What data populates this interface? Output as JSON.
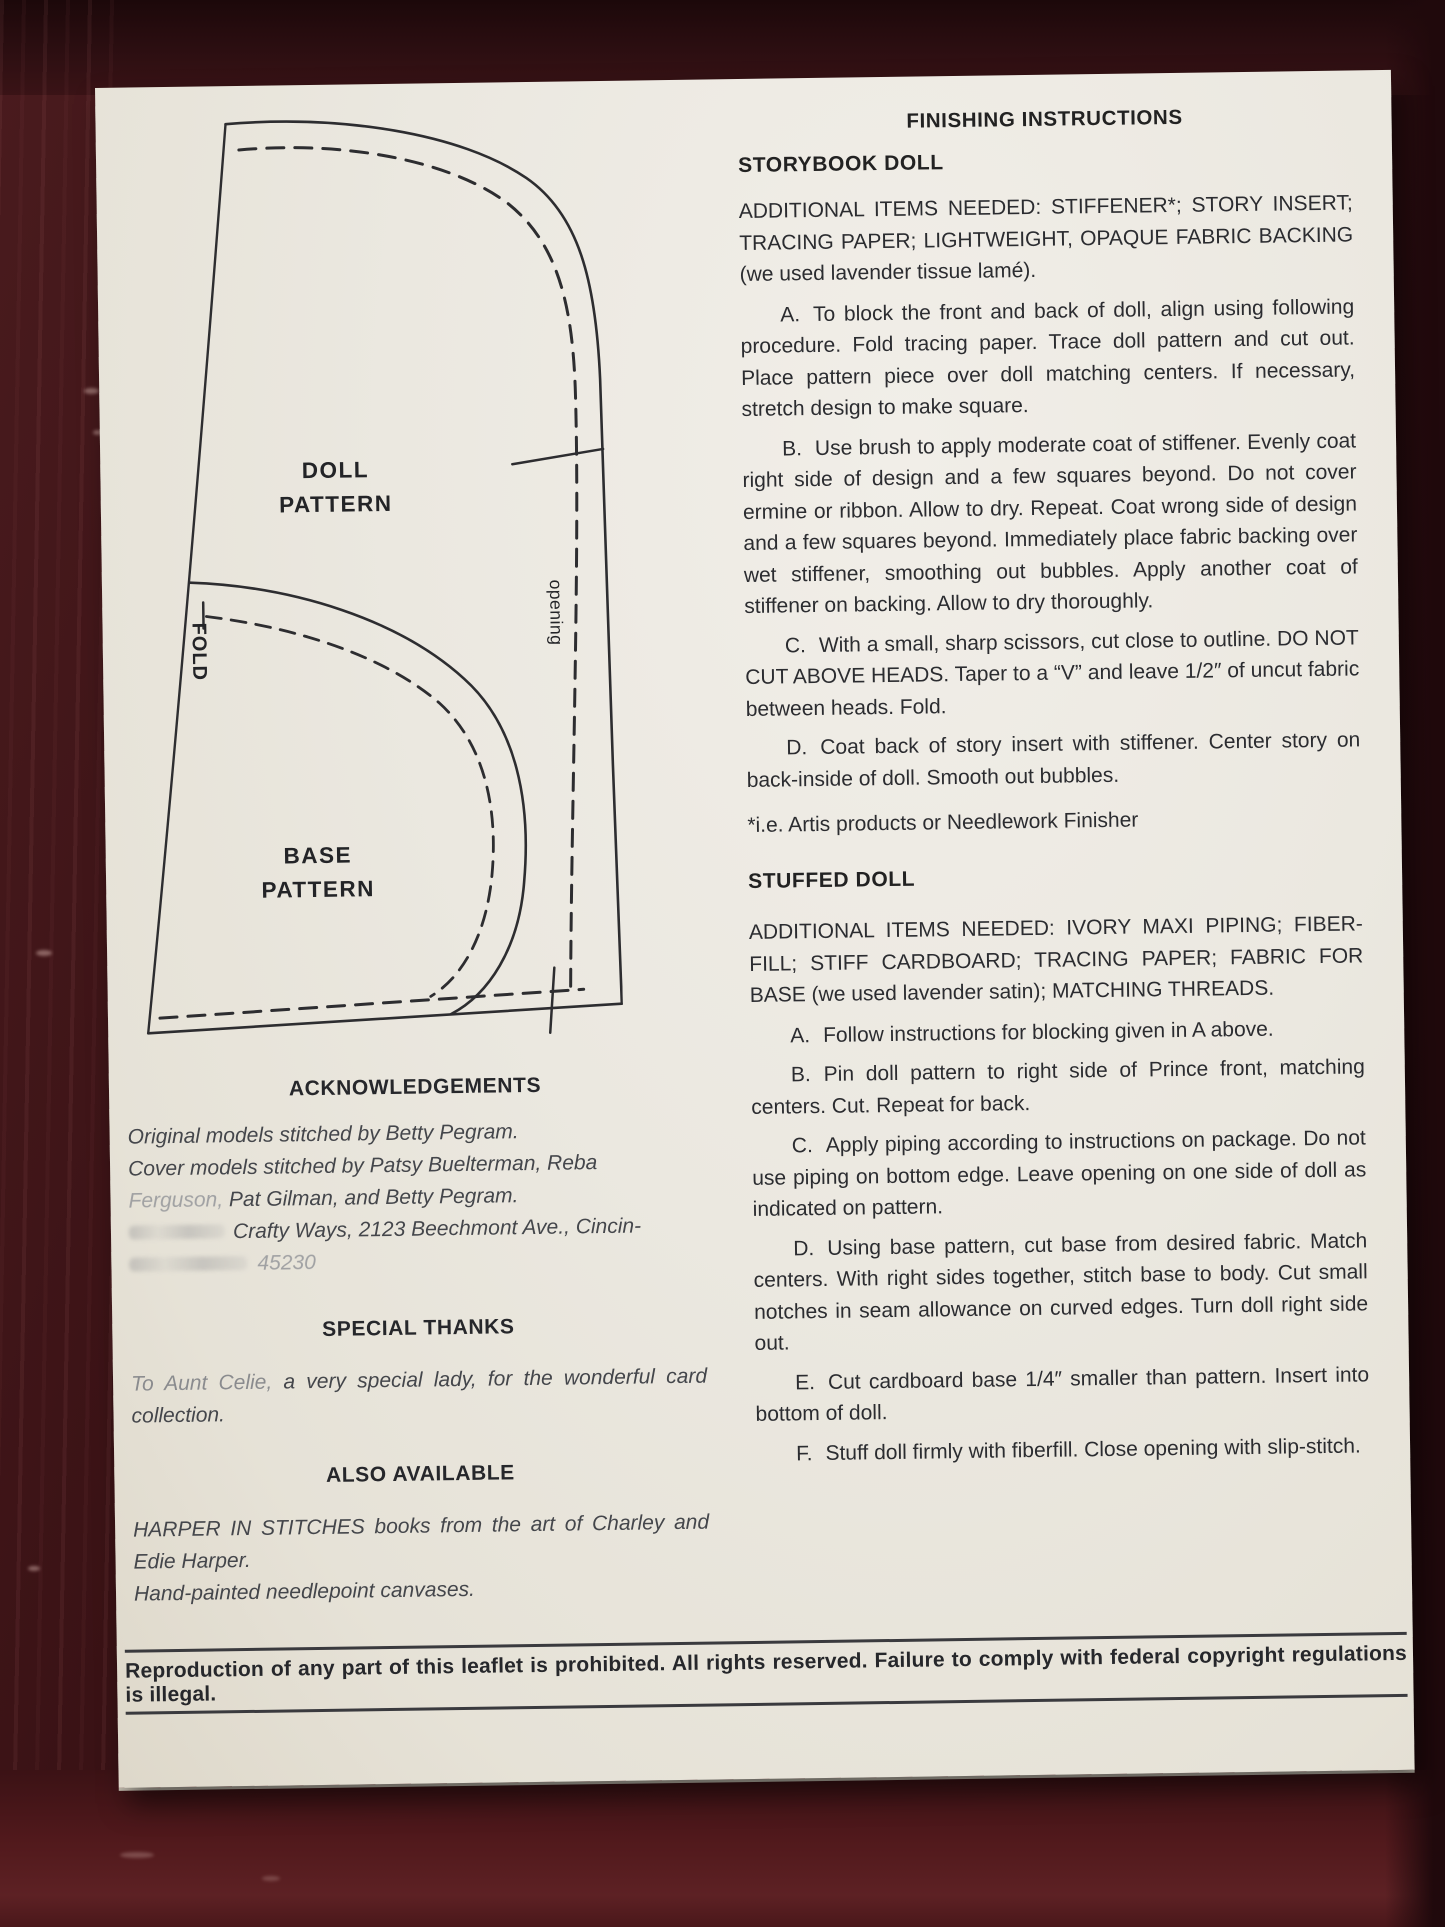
{
  "photo": {
    "wood_color": "#381114",
    "paper_color": "#ebe8e0",
    "ink_color": "#2b2c30"
  },
  "diagram": {
    "doll_label_line1": "DOLL",
    "doll_label_line2": "PATTERN",
    "base_label_line1": "BASE",
    "base_label_line2": "PATTERN",
    "fold_label": "FOLD",
    "opening_label": "opening"
  },
  "left_column": {
    "acknowledgements": {
      "heading": "ACKNOWLEDGEMENTS",
      "line1": "Original models stitched by Betty Pegram.",
      "line2": "Cover models stitched by Patsy Buelterman, Reba",
      "line3_faded": "Ferguson,",
      "line3_rest": "Pat Gilman, and Betty Pegram.",
      "line4": "Crafty Ways, 2123 Beechmont Ave., Cincin-",
      "line5_faded": "45230"
    },
    "special_thanks": {
      "heading": "SPECIAL THANKS",
      "lead_faded": "To Aunt Celie,",
      "body": "a very special lady, for the wonderful card collection."
    },
    "also_available": {
      "heading": "ALSO AVAILABLE",
      "line1": "HARPER IN STITCHES books from the art of Charley and Edie Harper.",
      "line2": "Hand-painted needlepoint canvases."
    }
  },
  "instructions": {
    "title": "FINISHING INSTRUCTIONS",
    "storybook": {
      "heading": "STORYBOOK DOLL",
      "intro": "ADDITIONAL ITEMS NEEDED: STIFFENER*; STORY INSERT; TRACING PAPER; LIGHTWEIGHT, OPAQUE FABRIC BACKING (we used lavender tissue lamé).",
      "steps": [
        {
          "label": "A.",
          "text": "To block the front and back of doll, align using following procedure. Fold tracing paper. Trace doll pattern and cut out. Place pattern piece over doll matching centers. If necessary, stretch design to make square."
        },
        {
          "label": "B.",
          "text": "Use brush to apply moderate coat of stiffener. Evenly coat right side of design and a few squares beyond. Do not cover ermine or ribbon. Allow to dry. Repeat. Coat wrong side of design and a few squares beyond. Immediately place fabric backing over wet stiffener, smoothing out bubbles. Apply another coat of stiffener on backing. Allow to dry thoroughly."
        },
        {
          "label": "C.",
          "text": "With a small, sharp scissors, cut close to outline. DO NOT CUT ABOVE HEADS. Taper to a “V” and leave 1/2″ of uncut fabric between heads. Fold."
        },
        {
          "label": "D.",
          "text": "Coat back of story insert with stiffener. Center story on back-inside of doll. Smooth out bubbles."
        }
      ],
      "footnote": "*i.e. Artis products or Needlework Finisher"
    },
    "stuffed": {
      "heading": "STUFFED DOLL",
      "intro": "ADDITIONAL ITEMS NEEDED: IVORY MAXI PIPING; FIBER-FILL; STIFF CARDBOARD; TRACING PAPER; FABRIC FOR BASE (we used lavender satin); MATCHING THREADS.",
      "steps": [
        {
          "label": "A.",
          "text": "Follow instructions for blocking given in A above."
        },
        {
          "label": "B.",
          "text": "Pin doll pattern to right side of Prince front, matching centers. Cut. Repeat for back."
        },
        {
          "label": "C.",
          "text": "Apply piping according to instructions on package. Do not use piping on bottom edge. Leave opening on one side of doll as indicated on pattern."
        },
        {
          "label": "D.",
          "text": "Using base pattern, cut base from desired fabric. Match centers. With right sides together, stitch base to body. Cut small notches in seam allowance on curved edges. Turn doll right side out."
        },
        {
          "label": "E.",
          "text": "Cut cardboard base 1/4″ smaller than pattern. Insert into bottom of doll."
        },
        {
          "label": "F.",
          "text": "Stuff doll firmly with fiberfill. Close opening with slip-stitch."
        }
      ]
    }
  },
  "footer": {
    "text": "Reproduction of any part of this leaflet is prohibited. All rights reserved. Failure to comply with federal copyright regulations is illegal."
  }
}
